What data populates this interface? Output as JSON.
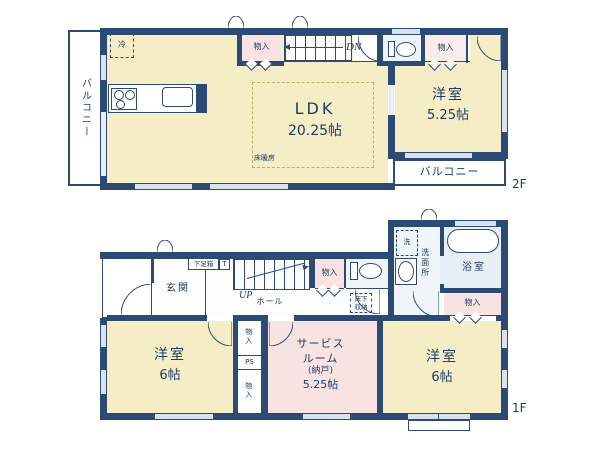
{
  "colors": {
    "wall": "#2c4a73",
    "room_cream": "#f4edc6",
    "closet_pink": "#f9e3e2",
    "bath_blue": "#e6eff6",
    "toilet_blue": "#eef4f8",
    "window": "#d9e3ee",
    "text": "#1e3c64",
    "heating_dash": "#bfae6f"
  },
  "f2": {
    "floor_label": "2F",
    "balcony_left": "バルコニー",
    "fridge": "冷",
    "closet_top": "物入",
    "stairs_dn": "DN",
    "closet_right": "物入",
    "ldk": {
      "name": "LDK",
      "size": "20.25帖"
    },
    "floor_heating": "床暖房",
    "bedroom": {
      "name": "洋室",
      "size": "5.25帖"
    },
    "balcony_bottom": "バルコニー"
  },
  "f1": {
    "floor_label": "1F",
    "entrance": "玄関",
    "shoe_box": "下足箱",
    "t": "T",
    "stairs_up": "UP",
    "hall": "ホール",
    "closet_hall": "物入",
    "underfloor_storage": [
      "床下",
      "収納"
    ],
    "washer": "洗",
    "washroom": "洗面所",
    "bath": "浴室",
    "closet_bath": "物入",
    "bedroom_left": {
      "name": "洋室",
      "size": "6帖"
    },
    "closet_mid_top": "物入",
    "ps": "PS",
    "closet_mid_bottom": "物入",
    "service_room": {
      "line1": "サービス",
      "line2": "ルーム",
      "line3": "(納戸)",
      "line4": "5.25帖"
    },
    "bedroom_right": {
      "name": "洋室",
      "size": "6帖"
    }
  }
}
